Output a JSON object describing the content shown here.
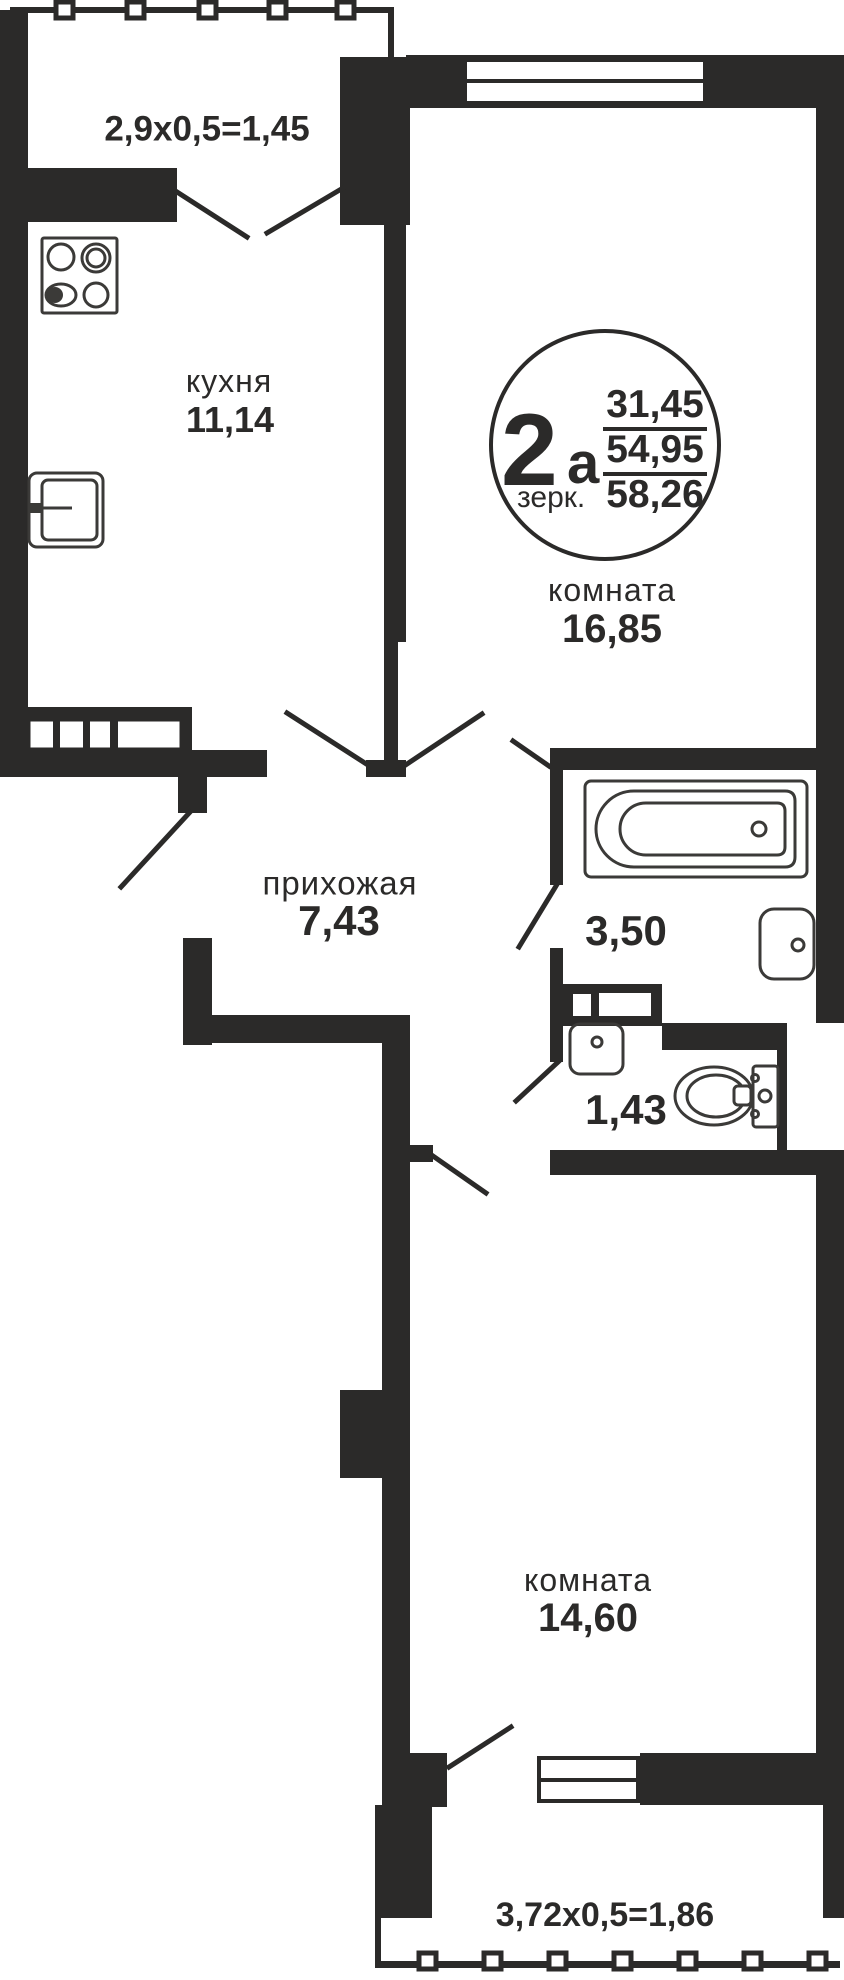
{
  "rooms": {
    "balcony_top": {
      "dim": "2,9х0,5=1,45"
    },
    "kitchen": {
      "name": "кухня",
      "area": "11,14"
    },
    "room_top": {
      "name": "комната",
      "area": "16,85"
    },
    "hallway": {
      "name": "прихожая",
      "area": "7,43"
    },
    "bathroom": {
      "area": "3,50"
    },
    "wc": {
      "area": "1,43"
    },
    "room_bottom": {
      "name": "комната",
      "area": "14,60"
    },
    "balcony_bottom": {
      "dim": "3,72х0,5=1,86"
    }
  },
  "badge": {
    "number": "2",
    "letter": "а",
    "note": "зерк.",
    "areas": [
      "31,45",
      "54,95",
      "58,26"
    ]
  },
  "colors": {
    "wall": "#2B2A29",
    "fixture": "#3B3A38",
    "background": "#FFFFFF"
  }
}
